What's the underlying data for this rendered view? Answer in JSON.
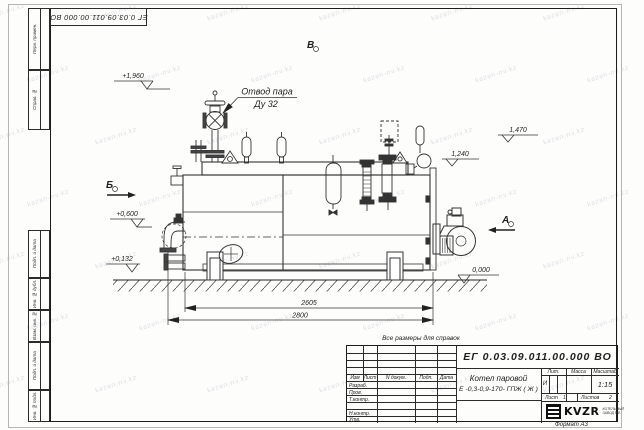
{
  "stamp_top_left": {
    "doc_number": "ЕГ 0.03.09.011.00.000  ВО"
  },
  "watermark": {
    "text": "kazan-nv.kz"
  },
  "margin": {
    "items": [
      {
        "label": "Перв. примен."
      },
      {
        "label": "Справ. №"
      },
      {
        "label": "Подп. и дата"
      },
      {
        "label": "Инв. № дубл."
      },
      {
        "label": "Взам. инв. №"
      },
      {
        "label": "Подп. и дата"
      },
      {
        "label": "Инв. № подл."
      }
    ]
  },
  "drawing": {
    "elev_top": "+1,960",
    "steam_label_1": "Отвод пара",
    "steam_label_2": "Ду 32",
    "view_v": "В",
    "view_b": "Б",
    "view_a": "А",
    "elev_1470": "1,470",
    "elev_1240": "1,240",
    "elev_0600": "+0,600",
    "elev_0132": "+0,132",
    "elev_0000": "0,000",
    "dim_2605": "2605",
    "dim_2800": "2800",
    "note": "Все размеры для справок"
  },
  "title_block": {
    "doc_number": "ЕГ 0.03.09.011.00.000  ВО",
    "product_name_line1": "Котел паровой",
    "product_name_line2": "Е -0,3-0,9-170- ГПЖ ( Ж )",
    "headers": {
      "izm": "Изм",
      "list": "Лист",
      "doc": "N докум.",
      "podp": "Подп.",
      "data": "Дата",
      "lit": "Лит.",
      "massa": "Масса",
      "masshtab": "Масштаб"
    },
    "rows": {
      "r1": "Разраб.",
      "r2": "Пров.",
      "r3": "Т.контр.",
      "r4": "",
      "r5": "Н.контр.",
      "r6": "Утв."
    },
    "lit_value": "И",
    "scale": "1:15",
    "sheet_label": "Лист",
    "sheet_value": "1",
    "sheets_label": "Листов",
    "sheets_value": "2",
    "logo_text": "KVZR",
    "logo_sub1": "КОТЕЛЬНЫЙ",
    "logo_sub2": "ЗАВОД Р.Ф.",
    "format_label": "Формат А3"
  }
}
